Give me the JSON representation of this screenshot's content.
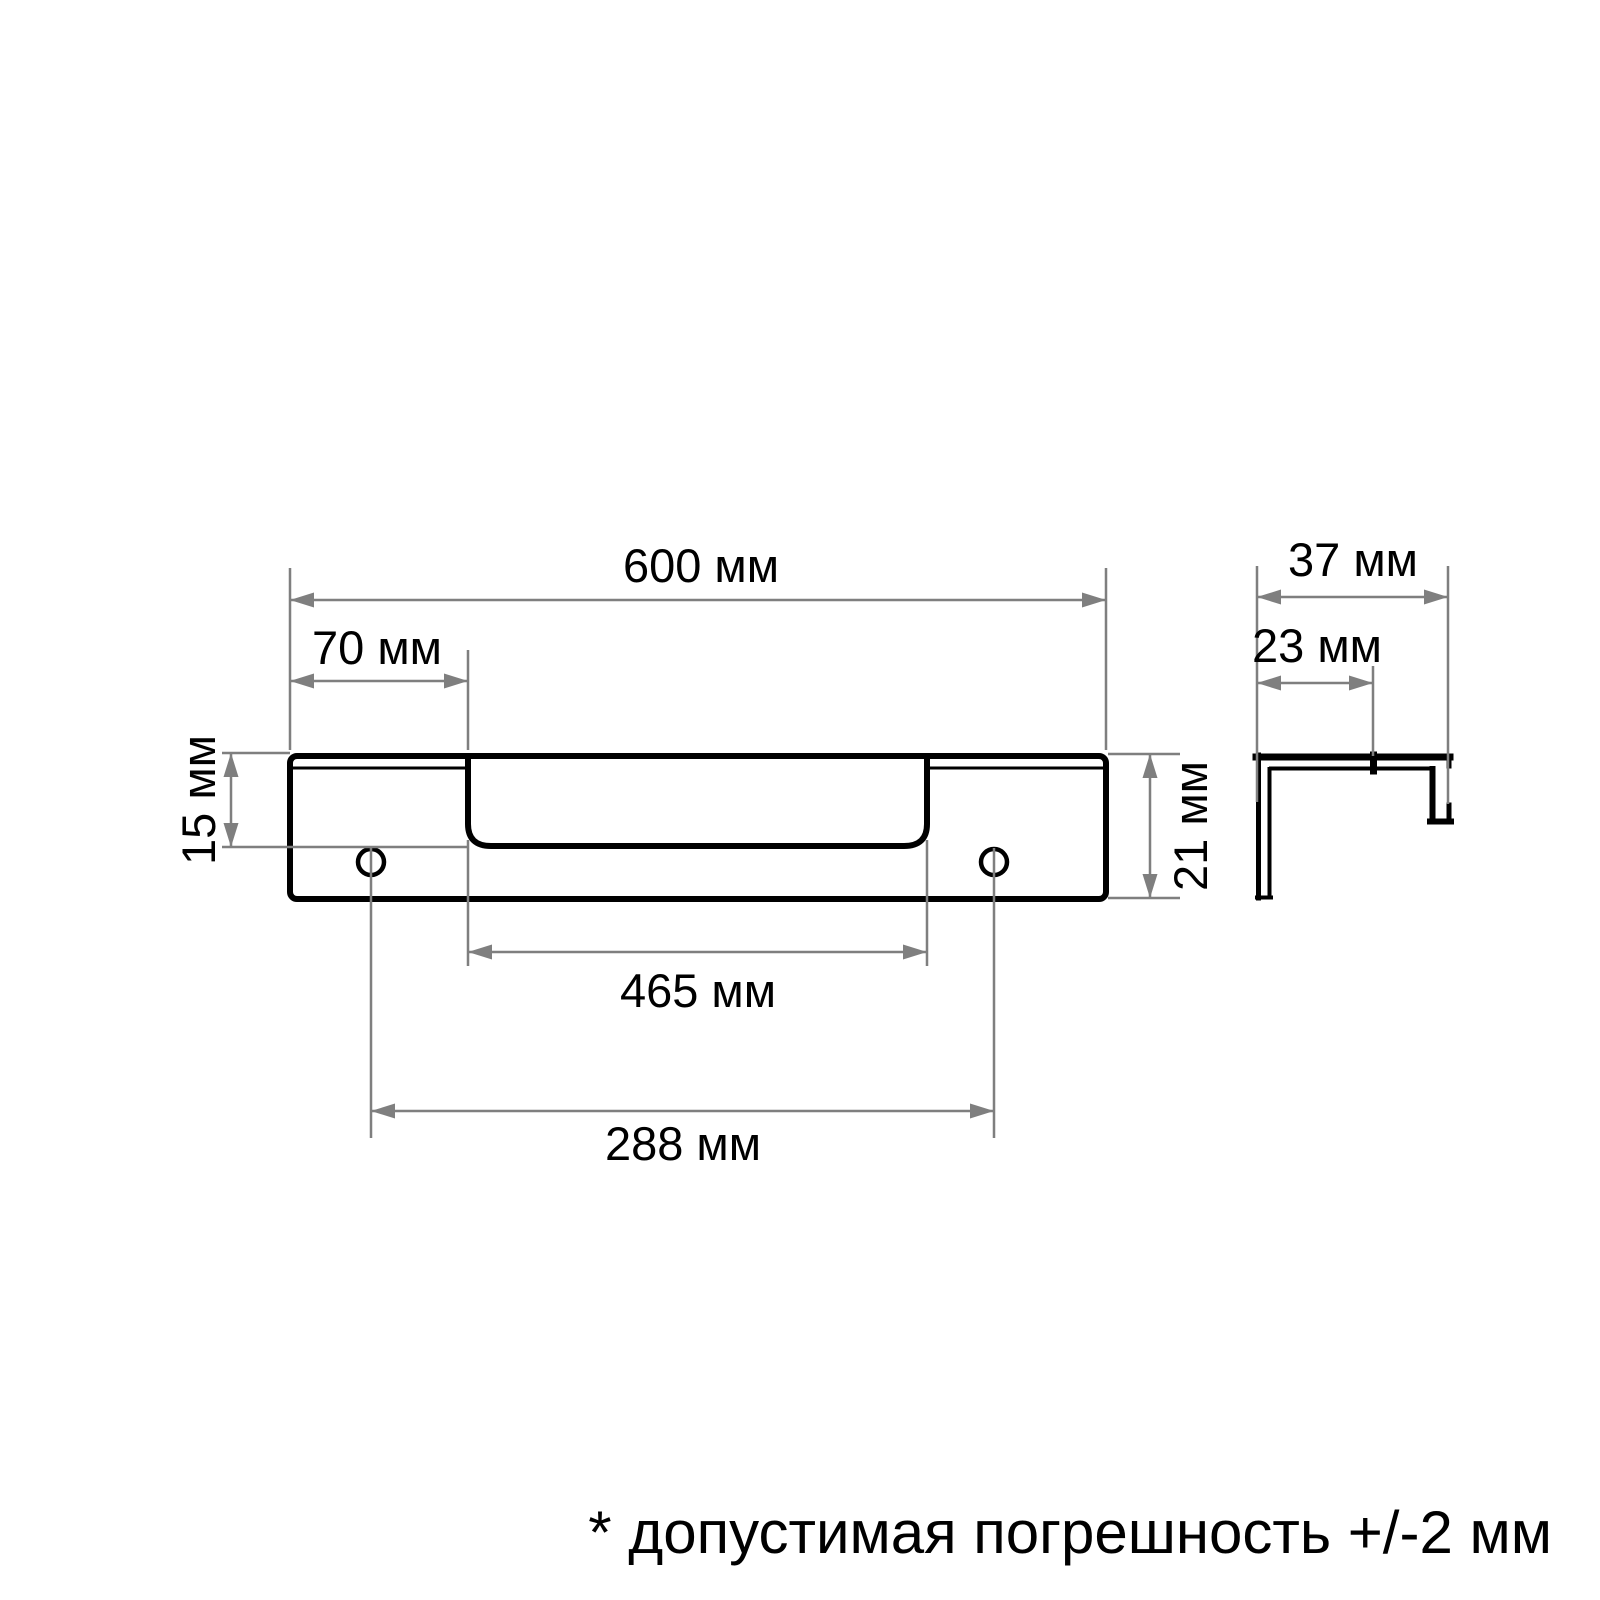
{
  "dimensions": {
    "total_length": {
      "label": "600 мм",
      "value": 600,
      "unit": "мм"
    },
    "left_offset": {
      "label": "70 мм",
      "value": 70,
      "unit": "мм"
    },
    "groove_depth": {
      "label": "15 мм",
      "value": 15,
      "unit": "мм"
    },
    "profile_height": {
      "label": "21 мм",
      "value": 21,
      "unit": "мм"
    },
    "recess_length": {
      "label": "465 мм",
      "value": 465,
      "unit": "мм"
    },
    "hole_spacing": {
      "label": "288 мм",
      "value": 288,
      "unit": "мм"
    },
    "side_depth": {
      "label": "37 мм",
      "value": 37,
      "unit": "мм"
    },
    "side_inner_depth": {
      "label": "23 мм",
      "value": 23,
      "unit": "мм"
    }
  },
  "note": {
    "text": "* допустимая погрешность +/-2 мм"
  },
  "colors": {
    "line": "#000000",
    "dimension": "#7f7f7f",
    "background": "#ffffff"
  }
}
